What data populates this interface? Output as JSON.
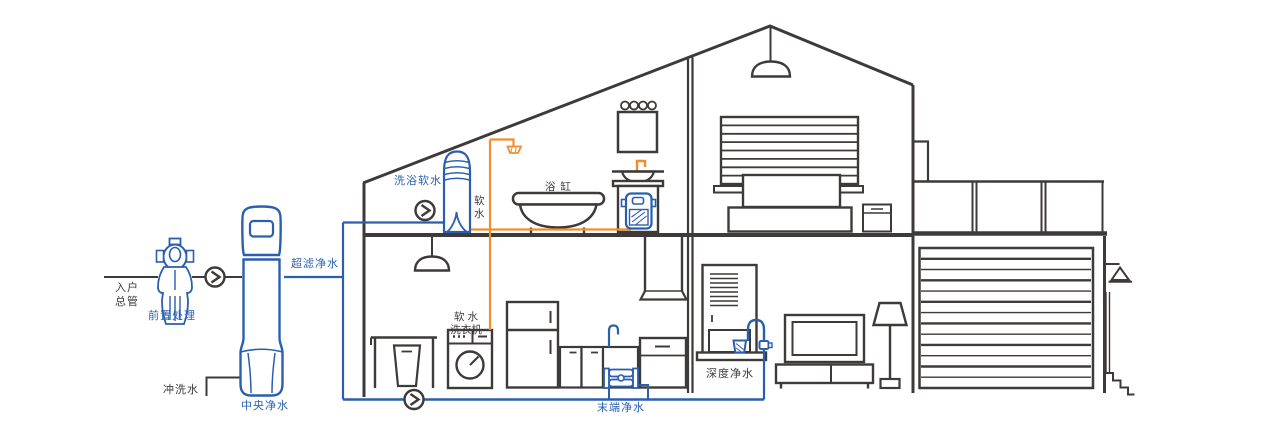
{
  "diagram": {
    "type": "home-water-purification-system-cutaway",
    "background": "#ffffff"
  },
  "colors": {
    "outline_dark": "#3d3a39",
    "pipe_blue": "#2a5fae",
    "pipe_orange": "#ef8e2e",
    "label_dark": "#3d3a39",
    "label_blue": "#2a5fae"
  },
  "labels": {
    "inlet_main": "入户\n总管",
    "pre_treatment": "前置处理",
    "flush_water": "冲洗水",
    "central_purifier": "中央净水",
    "ultrafiltration_water": "超滤净水",
    "bath_soft_water": "洗浴软水",
    "soft_water_vertical": "软\n水",
    "bathtub": "浴 缸",
    "soft_water_washer": "软 水\n洗衣机",
    "terminal_purified_water": "末端净水",
    "deep_purified_water": "深度净水"
  },
  "icons": {
    "flow_indicator": "chevron-right-in-circle",
    "flow_indicator_count": 3
  }
}
